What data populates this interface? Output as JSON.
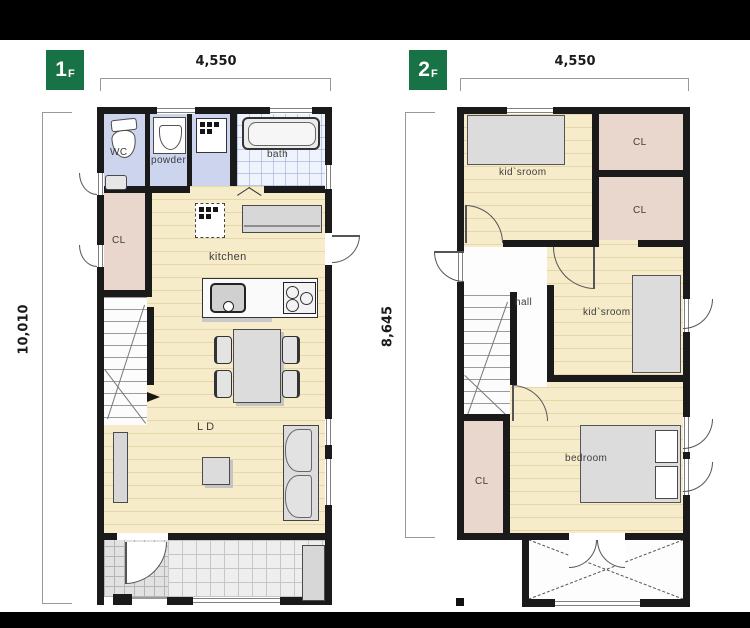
{
  "colors": {
    "accent_green": "#177245",
    "wall": "#1a1a1a",
    "floor_wood": "#f7ecca",
    "floor_closet": "#e9d7ce",
    "floor_wet": "#cdd4ee",
    "letterbox": "#000000"
  },
  "icons": {
    "washer": "black-square-dots",
    "fridge_placeholder": "dashed-box-dots",
    "balcony_mark": "dashed-x-cross"
  },
  "floor1": {
    "badge_number": "1",
    "badge_suffix": "F",
    "dim_top": "4,550",
    "dim_left": "10,010",
    "labels": {
      "wc": "WC",
      "powder": "powder",
      "bath": "bath",
      "closet": "CL",
      "kitchen": "kitchen",
      "living": "LD"
    }
  },
  "floor2": {
    "badge_number": "2",
    "badge_suffix": "F",
    "dim_top": "4,550",
    "dim_left": "8,645",
    "labels": {
      "kids_room_top": "kid`sroom",
      "closet_top": "CL",
      "closet_mid": "CL",
      "hall": "hall",
      "kids_room_mid": "kid`sroom",
      "bedroom": "bedroom",
      "closet_bottom": "CL"
    }
  }
}
